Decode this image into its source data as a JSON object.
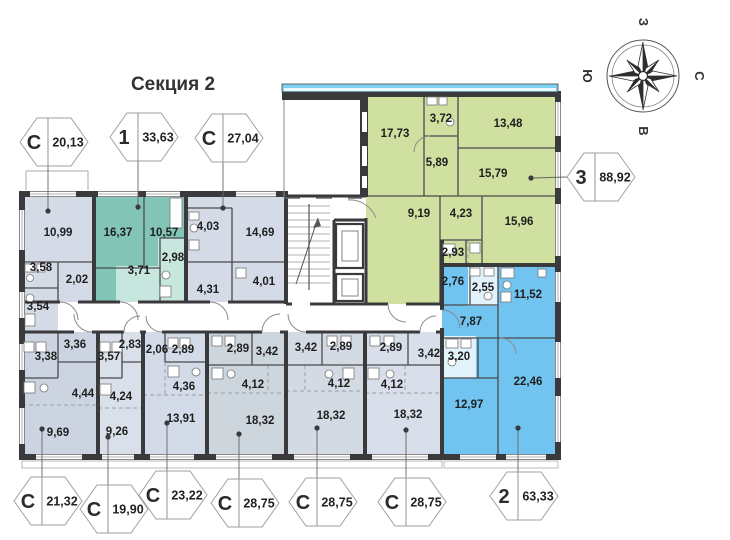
{
  "header": {
    "title": "Секция 2"
  },
  "compass": {
    "west": "З",
    "north": "С",
    "south": "Ю",
    "east": "В"
  },
  "palette": {
    "studio_fill": "#d4dbe7",
    "one_room_fill": "#82c5b6",
    "one_room_light": "#c6e6de",
    "three_room_fill": "#cfe0a0",
    "two_room_fill": "#70c4ef",
    "two_room_light": "#e2f3fc",
    "balcony_glass": "#7ed3f5",
    "wall": "#3a3a3c"
  },
  "apartments": [
    {
      "id": "studio-top-left",
      "badge": {
        "type": "С",
        "area": "20,13"
      },
      "rooms": [
        "10,99",
        "3,58",
        "2,02",
        "3,54"
      ]
    },
    {
      "id": "one-room",
      "badge": {
        "type": "1",
        "area": "33,63"
      },
      "rooms": [
        "16,37",
        "10,57",
        "3,71",
        "2,98"
      ]
    },
    {
      "id": "studio-top",
      "badge": {
        "type": "С",
        "area": "27,04"
      },
      "rooms": [
        "4,03",
        "14,69",
        "4,31",
        "4,01"
      ]
    },
    {
      "id": "three-room",
      "badge": {
        "type": "3",
        "area": "88,92"
      },
      "rooms": [
        "17,73",
        "3,72",
        "13,48",
        "5,89",
        "15,79",
        "9,19",
        "4,23",
        "15,96",
        "2,93"
      ]
    },
    {
      "id": "studio-b1",
      "badge": {
        "type": "С",
        "area": "21,32"
      },
      "rooms": [
        "3,36",
        "3,38",
        "4,44",
        "9,69"
      ]
    },
    {
      "id": "studio-b2",
      "badge": {
        "type": "С",
        "area": "19,90"
      },
      "rooms": [
        "2,83",
        "3,57",
        "4,24",
        "9,26"
      ]
    },
    {
      "id": "studio-b3",
      "badge": {
        "type": "С",
        "area": "23,22"
      },
      "rooms": [
        "2,06",
        "2,89",
        "4,36",
        "13,91"
      ]
    },
    {
      "id": "studio-b4",
      "badge": {
        "type": "С",
        "area": "28,75"
      },
      "rooms": [
        "2,89",
        "3,42",
        "4,12",
        "18,32"
      ]
    },
    {
      "id": "studio-b5",
      "badge": {
        "type": "С",
        "area": "28,75"
      },
      "rooms": [
        "3,42",
        "2,89",
        "4,12",
        "18,32"
      ]
    },
    {
      "id": "studio-b6",
      "badge": {
        "type": "С",
        "area": "28,75"
      },
      "rooms": [
        "2,89",
        "3,42",
        "4,12",
        "18,32"
      ]
    },
    {
      "id": "two-room",
      "badge": {
        "type": "2",
        "area": "63,33"
      },
      "rooms": [
        "2,76",
        "2,55",
        "11,52",
        "7,87",
        "3,20",
        "22,46",
        "12,97"
      ]
    }
  ]
}
